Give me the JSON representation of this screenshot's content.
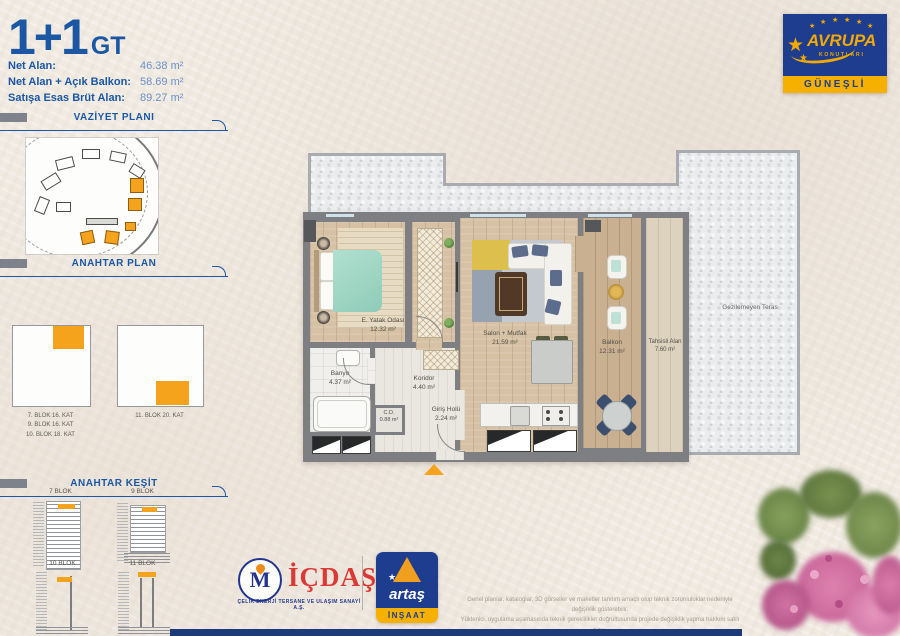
{
  "header": {
    "title": "1+1",
    "title_suffix": "GT",
    "stats": [
      {
        "label": "Net Alan:",
        "value": "46.38 m²"
      },
      {
        "label": "Net Alan + Açık Balkon:",
        "value": "58.69 m²"
      },
      {
        "label": "Satışa Esas Brüt Alan:",
        "value": "89.27 m²"
      }
    ]
  },
  "brand": {
    "name": "AVRUPA",
    "subname": "KONUTLARI",
    "location": "GÜNEŞLİ"
  },
  "icons": {
    "star": "★"
  },
  "sidebar": {
    "site_plan_title": "VAZİYET PLANI",
    "key_plan_title": "ANAHTAR PLAN",
    "key_plan_captions_left": [
      "7. BLOK 16. KAT",
      "9. BLOK 16. KAT",
      "10. BLOK 18. KAT"
    ],
    "key_plan_caption_right": "11. BLOK 20. KAT",
    "key_section_title": "ANAHTAR KEŞİT",
    "key_section_blocks": [
      "7 BLOK",
      "9 BLOK",
      "10 BLOK",
      "11 BLOK"
    ]
  },
  "plan": {
    "rooms": {
      "bedroom": {
        "name": "E. Yatak Odası",
        "area": "12.32 m²"
      },
      "living": {
        "name": "Salon + Mutfak",
        "area": "21.59 m²"
      },
      "bath": {
        "name": "Banyo",
        "area": "4.37 m²"
      },
      "corridor": {
        "name": "Koridor",
        "area": "4.40 m²"
      },
      "entry": {
        "name": "Giriş Holü",
        "area": "2.24 m²"
      },
      "closet": {
        "name": "C.D.",
        "area": "0.88 m²"
      },
      "balcony": {
        "name": "Balkon",
        "area": "12.31 m²"
      },
      "allocated": {
        "name": "Tahsisli Alan",
        "area": "7.60 m²"
      },
      "terrace": {
        "name": "Gezilemeyen Teras"
      }
    }
  },
  "footer": {
    "icdas": {
      "name": "İÇDAŞ",
      "monogram": "M",
      "subtitle": "ÇELİK ENERJİ TERSANE VE ULAŞIM SANAYİ A.Ş."
    },
    "artas": {
      "name": "artaş",
      "band": "İNŞAAT"
    },
    "disclaimer": [
      "Genel planlar, kataloglar, 3D görseller ve maketler tanıtım amaçlı olup teknik zorunluluklar nedeniyle değişiklik gösterebilir.",
      "Yüklenici, uygulama aşamasında teknik gereklilikler doğrultusunda projede değişiklik yapma hakkını saklı tutar.",
      "Kat bahçeleri örnek olarak gösterilmiş olup tefrişat ve dekorasyon satışa dahil değildir."
    ]
  },
  "colors": {
    "blue": "#1b57a3",
    "navy": "#1e3d8f",
    "orange": "#f5a31d",
    "yellow": "#f5b000",
    "red": "#d93a35"
  }
}
